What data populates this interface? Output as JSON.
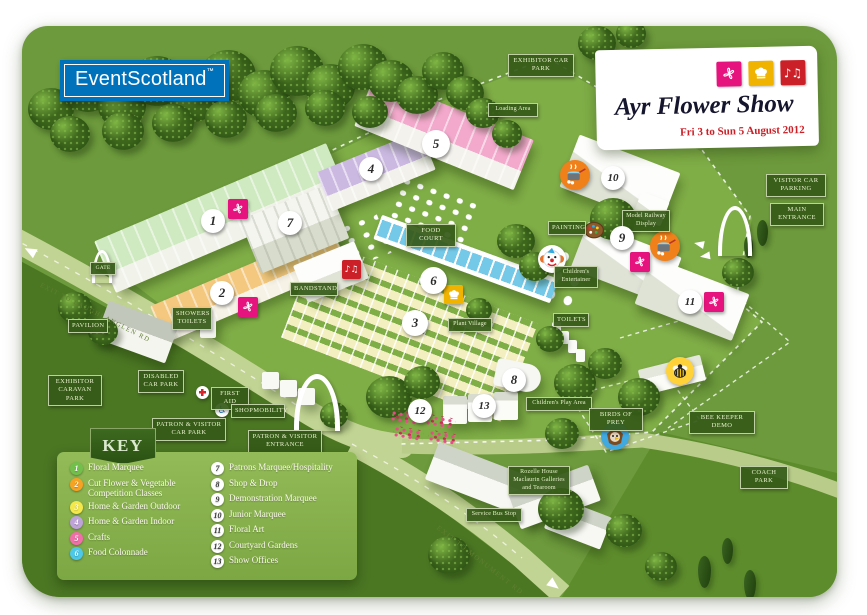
{
  "logo": {
    "text": "EventScotland",
    "tm": "™",
    "bg_color": "#0072bc"
  },
  "banner": {
    "title": "Ayr Flower Show",
    "dates": "Fri 3 to Sun 5 August 2012",
    "icon_colors": {
      "flower": "#e6127d",
      "chef": "#f0b400",
      "music": "#cb2027"
    }
  },
  "glyphs": {
    "music": "♪♫",
    "wheelchair": "♿"
  },
  "key": {
    "title": "KEY",
    "items": [
      {
        "num": "1",
        "label": "Floral Marquee",
        "color": "#72bf4c"
      },
      {
        "num": "2",
        "label": "Cut Flower & Vegetable Competition Classes",
        "color": "#f6a223"
      },
      {
        "num": "3",
        "label": "Home & Garden Outdoor",
        "color": "#f4e84b"
      },
      {
        "num": "4",
        "label": "Home & Garden Indoor",
        "color": "#bea3d8"
      },
      {
        "num": "5",
        "label": "Crafts",
        "color": "#ef6fa9"
      },
      {
        "num": "6",
        "label": "Food Colonnade",
        "color": "#4cc8e8"
      },
      {
        "num": "7",
        "label": "Patrons Marquee/Hospitality",
        "color": "#ffffff"
      },
      {
        "num": "8",
        "label": "Shop & Drop",
        "color": "#ffffff"
      },
      {
        "num": "9",
        "label": "Demonstration Marquee",
        "color": "#ffffff"
      },
      {
        "num": "10",
        "label": "Junior Marquee",
        "color": "#ffffff"
      },
      {
        "num": "11",
        "label": "Floral Art",
        "color": "#ffffff"
      },
      {
        "num": "12",
        "label": "Courtyard Gardens",
        "color": "#ffffff"
      },
      {
        "num": "13",
        "label": "Show Offices",
        "color": "#ffffff"
      }
    ]
  },
  "labels": {
    "gate": "GATE",
    "exhibitor_car_park": "EXHIBITOR CAR PARK",
    "loading_area": "Loading Area",
    "visitor_car_parking": "VISITOR CAR PARKING",
    "main_entrance": "MAIN ENTRANCE",
    "food_court": "FOOD COURT",
    "bandstand": "BANDSTAND",
    "plant_village": "Plant Village",
    "toilets": "TOILETS",
    "showers_toilets": "SHOWERS TOILETS",
    "pavilion": "PAVILION",
    "exhibitor_caravan_park": "EXHIBITOR CARAVAN PARK",
    "disabled_car_park": "DISABLED CAR PARK",
    "first_aid": "FIRST AID",
    "shopmobility": "SHOPMOBILITY",
    "patron_visitor_car_park": "PATRON & VISITOR CAR PARK",
    "patron_visitor_entrance": "PATRON & VISITOR ENTRANCE",
    "model_railway": "Model Railway Display",
    "painting": "PAINTING",
    "childrens_entertainer": "Children's Entertainer",
    "childrens_play_area": "Children's Play Area",
    "birds_of_prey": "BIRDS OF PREY",
    "bee_keeper_demo": "BEE KEEPER DEMO",
    "coach_park": "COACH PARK",
    "rozelle_house": "Rozelle House Maclaurin Galleries and Tearoom",
    "service_bus_stop": "Service Bus Stop",
    "exit_laughlanglen": "EXIT TO LAUGHLANGLEN RD",
    "exit_monument": "EXIT TO MONUMENT RD"
  }
}
